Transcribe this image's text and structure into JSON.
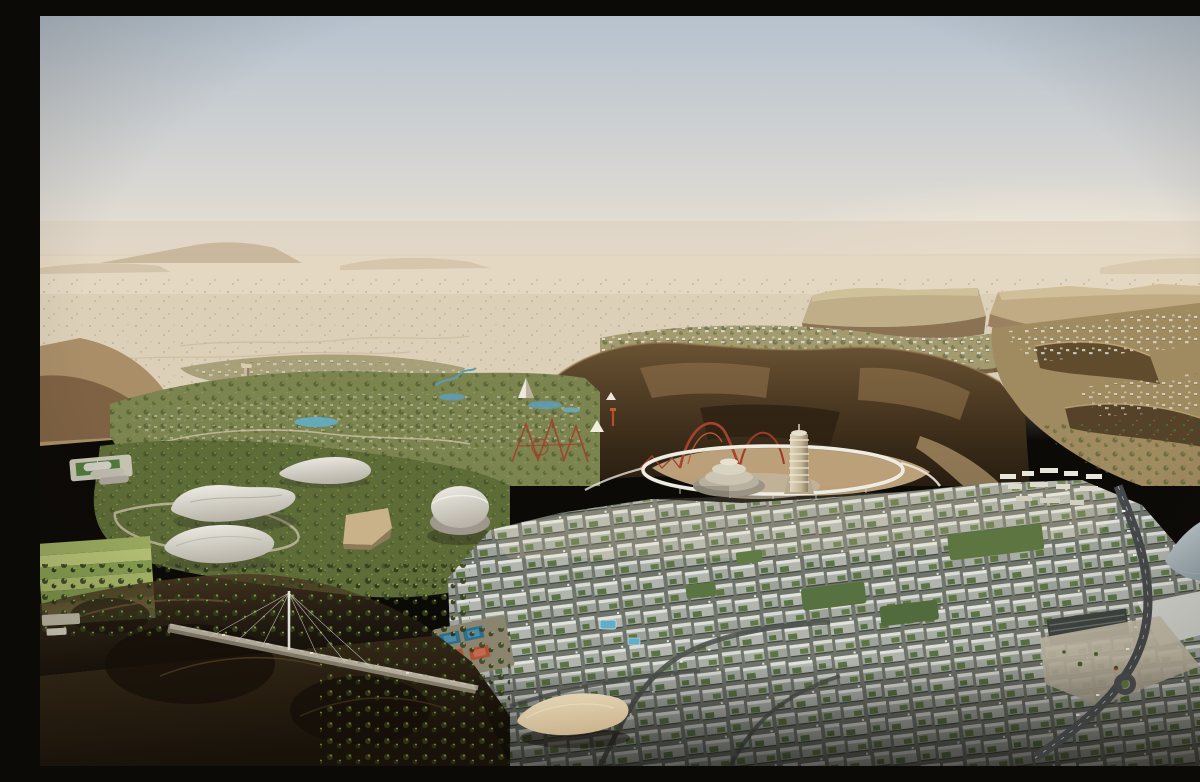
{
  "image": {
    "title": "Aerial rendering of a futuristic desert entertainment city built around sandstone canyons",
    "style": "photorealistic 3D architectural render, high aerial viewpoint",
    "lighting": "hazy backlit afternoon sun from the upper right",
    "setting": "vast pale desert plain with mesas on the horizon, cliff-edged canyons in the midground, dense green-roofed city grid in the foreground"
  },
  "regions": {
    "sky": {
      "label": "Hazy pale blue-grey sky fading to warm beige at the horizon"
    },
    "distant_plain": {
      "label": "Distant flat desert plain with faint mesa silhouettes"
    },
    "right_mesas": {
      "label": "Sunlit flat-topped mesas and terraced cliffs on the right"
    },
    "villa_terraces": {
      "label": "Plateau terraces dotted with white villas and trees"
    },
    "canyon": {
      "label": "Dark shadowed canyon walls behind the city centre"
    },
    "upper_left_development": {
      "label": "Sparse low-rise development and winding roads on the plain"
    },
    "observation_tower": {
      "label": "Slender observation tower on the plain"
    },
    "rock_pinnacle": {
      "label": "Jagged sunlit rock outcrop amid the theme park"
    },
    "theme_park": {
      "label": "Theme-park zone with pools, tents and red roller-coaster track"
    },
    "roller_coaster": {
      "label": "Red roller-coaster arches against the dark canyon"
    },
    "shell_pavilions": {
      "label": "White wave-shaped shell-roof pavilions on green parkland"
    },
    "dome_arena": {
      "label": "Large white dome arena at the edge of the city grid"
    },
    "central_ring": {
      "label": "Elevated white ring track encircling the canyon-floor plaza"
    },
    "tiered_rotunda": {
      "label": "Stacked circular tiered building inside the ring"
    },
    "spiral_tower": {
      "label": "Ribbed spiral tower rising beside the ring"
    },
    "city_grid": {
      "label": "Dense low-rise city grid with green planted rooftops"
    },
    "lawns": {
      "label": "Large rectangular rooftop lawns within the city"
    },
    "grey_shell_building": {
      "label": "Faceted grey shell-roofed building at the right edge"
    },
    "plaza": {
      "label": "Paved public plaza beside the highway"
    },
    "highway": {
      "label": "Curving highway with traffic entering the city"
    },
    "bridge": {
      "label": "Cable-stayed road bridge crossing the dark ravine"
    },
    "tennis_courts": {
      "label": "Cluster of blue and clay tennis courts"
    },
    "pools": {
      "label": "Small turquoise swimming pools among the blocks"
    },
    "canopy_pavilion": {
      "label": "Sand-coloured fabric canopy pavilion"
    },
    "farmland": {
      "label": "Striped green agricultural plots on the lower left"
    },
    "sports_pitch": {
      "label": "Small green sports pitch on the left plateau"
    },
    "foreground_canyon": {
      "label": "Deep shadowed rocky ravines with scattered trees in the foreground"
    }
  },
  "palette": {
    "sky_top": "#b6c2ce",
    "sky_mid": "#d7d6d3",
    "sky_horizon": "#efe3d1",
    "sun_glow": "#fdf3e0",
    "plain_far": "#e4d8c4",
    "plain": "#ddd0b9",
    "mesa_top": "#bfae88",
    "mesa_face": "#8a7253",
    "cliff_lit": "#a98e68",
    "canyon_dark": "#43321d",
    "canyon_deep": "#271d10",
    "sand_floor": "#c3a87f",
    "veg_dark": "#42522a",
    "veg_mid": "#5e6c38",
    "veg_light": "#8d9c4a",
    "shell_white": "#f0eee7",
    "shell_shade": "#b9b5aa",
    "city_street": "#70756c",
    "city_wall": "#aeb3ad",
    "city_roof": "#e2e4de",
    "roof_green": "#5d7540",
    "coaster_red": "#a8422d",
    "road": "#46494b",
    "court_blue": "#2e6e8c",
    "court_clay": "#ad5238",
    "pool_blue": "#62aec6",
    "canopy_beige": "#d9c29a",
    "bridge_deck": "#b8b1a0",
    "plaza_paving": "#c5bca8"
  }
}
